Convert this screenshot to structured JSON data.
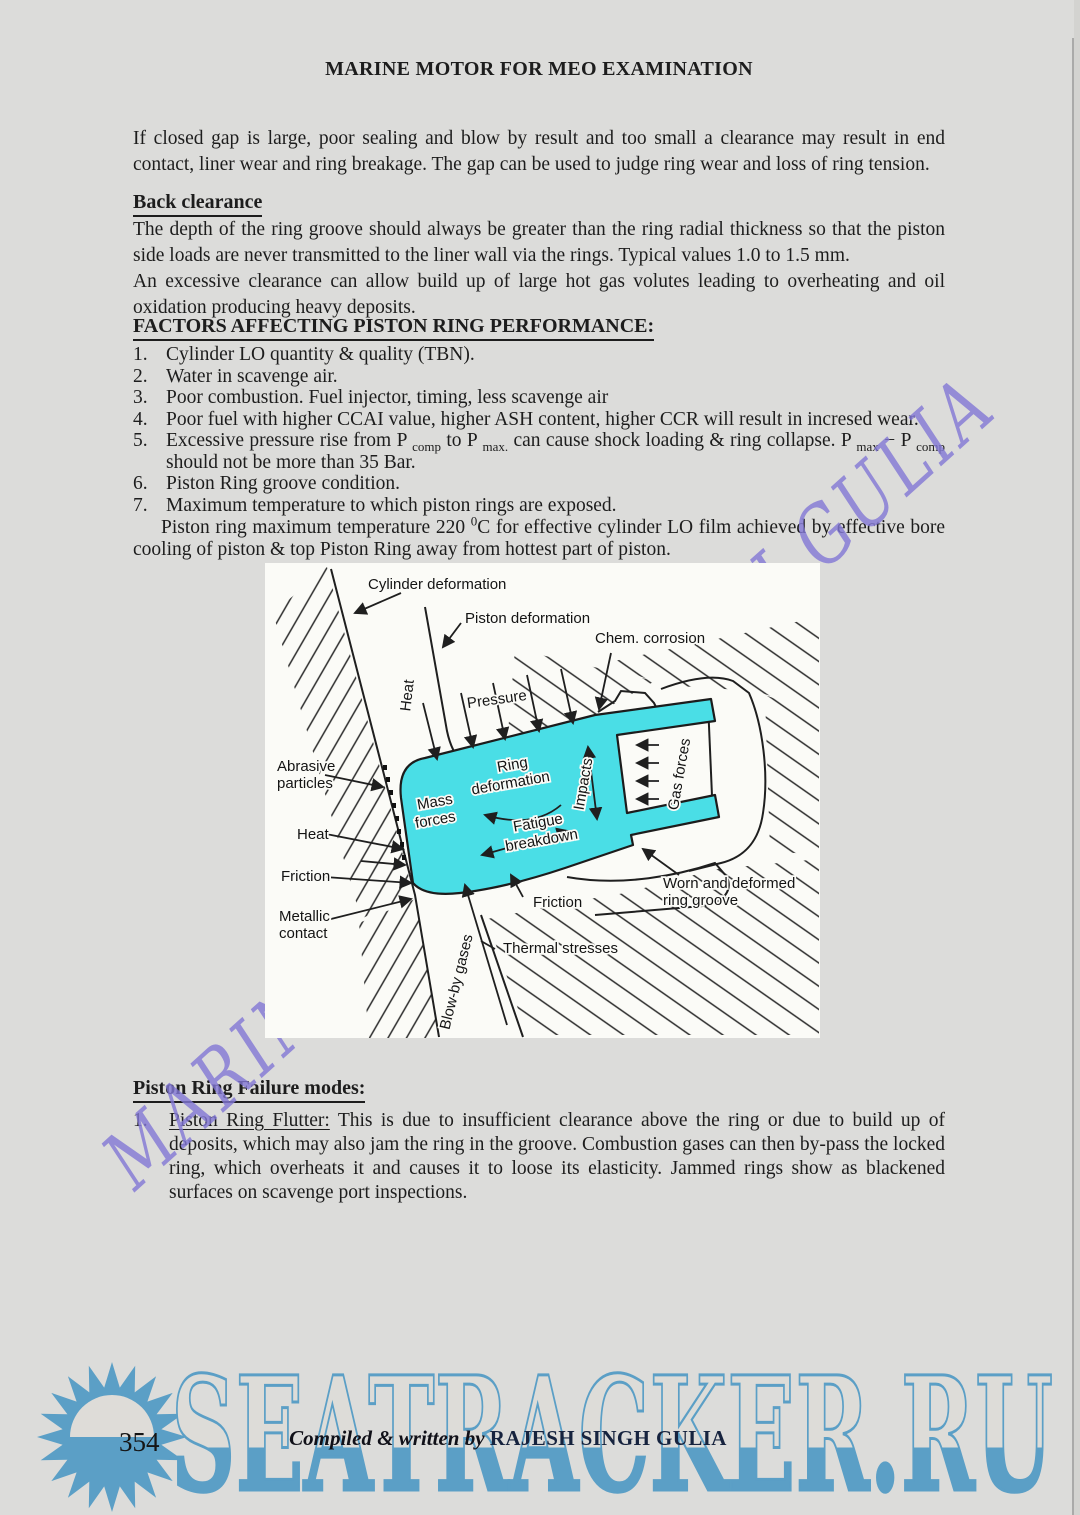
{
  "page": {
    "title": "MARINE MOTOR FOR MEO EXAMINATION",
    "intro": "If closed gap is large, poor sealing and blow by result and too small a clearance may result in end contact, liner wear and ring breakage. The gap can be used to judge ring wear and loss of ring tension.",
    "page_number": "354",
    "credit_prefix": "Compiled & written by ",
    "credit_name": "RAJESH SINGH GULIA"
  },
  "back_clearance": {
    "heading": "Back clearance",
    "para1": "The depth of the ring groove should always be greater than the ring radial thickness so that the piston side loads are never transmitted to the liner wall via the rings. Typical values 1.0 to 1.5 mm.",
    "para2": "An excessive clearance can allow build up of large hot gas volutes leading to overheating and oil oxidation producing heavy deposits."
  },
  "factors": {
    "heading": "FACTORS AFFECTING PISTON RING PERFORMANCE:",
    "item1_num": "1.",
    "item1": "Cylinder LO quantity & quality (TBN).",
    "item2_num": "2.",
    "item2": "Water in scavenge air.",
    "item3_num": "3.",
    "item3": "Poor combustion.  Fuel injector, timing, less scavenge air",
    "item4_num": "4.",
    "item4": "Poor fuel with higher CCAI value, higher ASH content, higher CCR will result in incresed wear.",
    "item5_num": "5.",
    "item5_seg1": "Excessive pressure rise from P ",
    "item5_sub1": "comp",
    "item5_seg2": " to P ",
    "item5_sub2": "max.",
    "item5_seg3": " can cause shock loading & ring collapse. P ",
    "item5_sub3": "max",
    "item5_seg4": " − P ",
    "item5_sub4": "comp",
    "item5_seg5": " should not be more than 35 Bar.",
    "item6_num": "6.",
    "item6": "Piston Ring groove condition.",
    "item7_num": "7.",
    "item7": "Maximum temperature to which piston rings are exposed.",
    "note_seg1": "Piston ring maximum temperature 220 ",
    "note_sup": "0",
    "note_seg2": "C for effective cylinder LO film achieved by effective bore cooling of piston &  top Piston Ring away from hottest part of piston."
  },
  "diagram": {
    "labels": {
      "cylinder_deformation": "Cylinder deformation",
      "piston_deformation": "Piston deformation",
      "chem_corrosion": "Chem. corrosion",
      "pressure": "Pressure",
      "heat_top": "Heat",
      "abrasive_1": "Abrasive",
      "abrasive_2": "particles",
      "heat_left": "Heat",
      "friction_left": "Friction",
      "metallic_1": "Metallic",
      "metallic_2": "contact",
      "mass_1": "Mass",
      "mass_2": "forces",
      "ringdef_1": "Ring",
      "ringdef_2": "deformation",
      "fatigue_1": "Fatigue",
      "fatigue_2": "breakdown",
      "impacts": "Impacts",
      "gas_forces": "Gas forces",
      "blow_by": "Blow-by gases",
      "friction_bottom": "Friction",
      "thermal": "Thermal stresses",
      "worn_1": "Worn and deformed",
      "worn_2": "ring groove"
    }
  },
  "failure": {
    "heading": "Piston Ring Failure modes:",
    "item1_num": "1.",
    "item1_title": "Piston Ring Flutter:",
    "item1_text": " This is due to insufficient clearance above the ring or due to build up of deposits, which may also jam the ring in the groove. Combustion gases can then by-pass the locked ring, which overheats it and causes it to loose its elasticity. Jammed rings show as blackened surfaces on scavenge port inspections."
  },
  "watermarks": {
    "diagonal_text": "MARINE RAJESH SINGH GULIA",
    "site_text": "SEATRACKER.RU"
  },
  "colors": {
    "accent_cyan": "#4ADEE6",
    "watermark_purple": "#8378D6",
    "site_blue": "#5B9FC6",
    "page_bg": "#DCDCDA",
    "diagram_bg": "#FBFBF7"
  }
}
